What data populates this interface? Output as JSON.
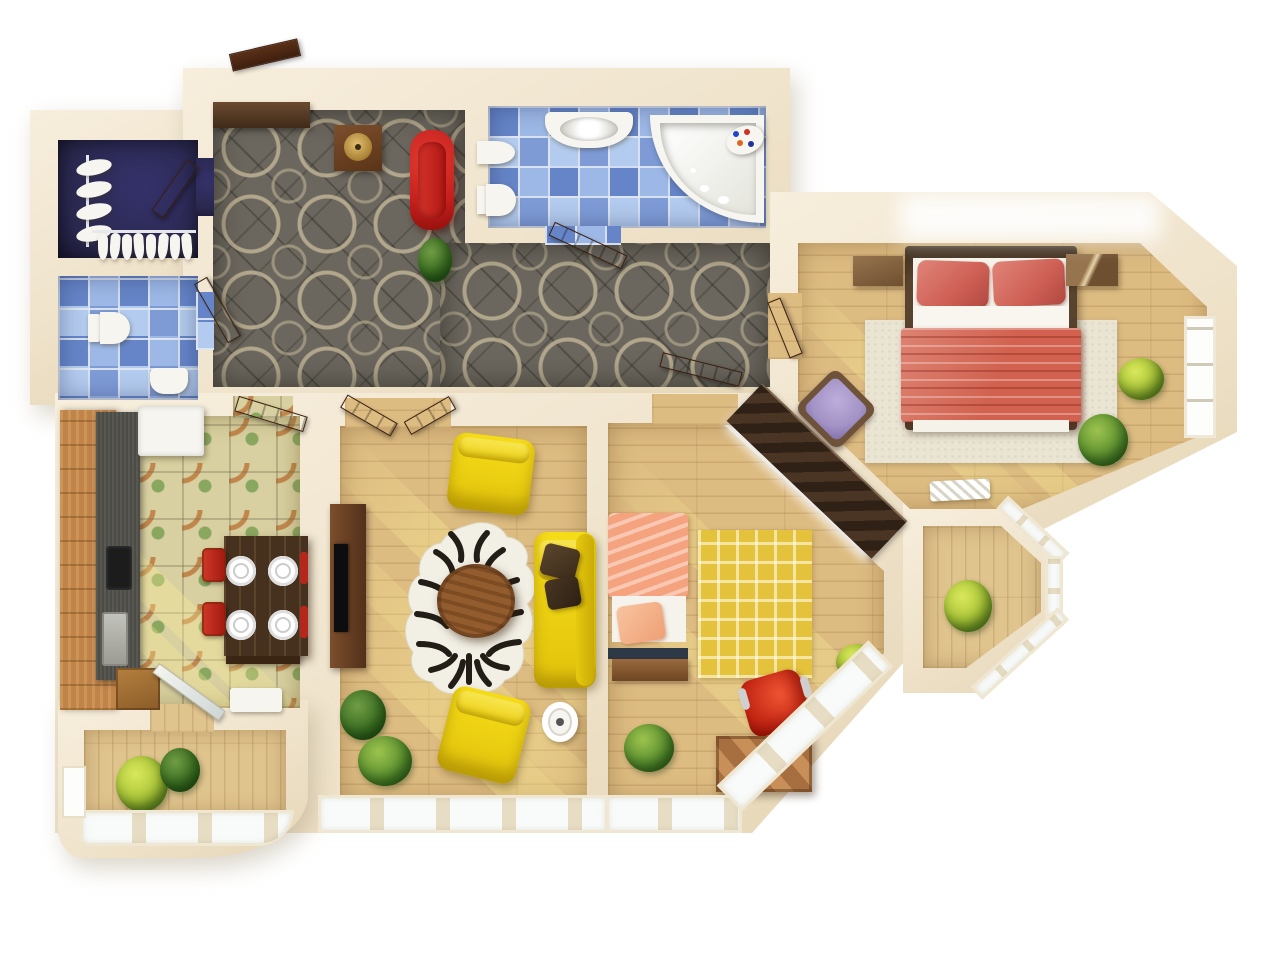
{
  "title": "3D apartment floor plan (top-down render)",
  "colors": {
    "wall": "#efe3cb",
    "wallLight": "#f7eedd",
    "woodFloor": "#ddbc82",
    "woodFloorLight": "#e0c48e",
    "carpet": "#6b675e",
    "tileBlue": "#7e9bd6",
    "tileGreen": "#d8d0a0",
    "navy": "#2b2950",
    "accentRed": "#c41f1c",
    "sofaYellow": "#f0d313",
    "bedCoral": "#d2614f",
    "pillowCoral": "#ce5f55",
    "kidsPeach": "#f5a37f",
    "rugYellow": "#e4c23c",
    "rugBeige": "#eae4d3",
    "doorWood": "#5f351f",
    "darkWood": "#46311f",
    "counterWood": "#c08449",
    "plantGreen": "#5e9330"
  },
  "rooms": [
    {
      "id": "entry-hall",
      "name": "Entry hall with patterned gray carpet"
    },
    {
      "id": "closet",
      "name": "Wardrobe closet with shoe racks"
    },
    {
      "id": "wc",
      "name": "WC with blue mosaic tile"
    },
    {
      "id": "bathroom",
      "name": "Bathroom with blue mosaic tile"
    },
    {
      "id": "bedroom",
      "name": "Master bedroom with double bed"
    },
    {
      "id": "kitchen",
      "name": "Kitchen with green tile and dining table"
    },
    {
      "id": "living-room",
      "name": "Living room with yellow sofa set"
    },
    {
      "id": "kids-room",
      "name": "Second bedroom / study"
    },
    {
      "id": "balcony-left",
      "name": "Curved balcony with plants"
    },
    {
      "id": "balcony-right",
      "name": "Small bay balcony"
    }
  ],
  "furniture": {
    "entry_hall": [
      "entrance door",
      "wall cabinet",
      "side table with brass bowl",
      "red bench",
      "plant"
    ],
    "closet": [
      "hanger rail",
      "shoe shelves",
      "door"
    ],
    "wc": [
      "toilet",
      "small sink"
    ],
    "bathroom": [
      "vanity sink",
      "bidet",
      "toilet",
      "corner bathtub",
      "soap tray"
    ],
    "bedroom": [
      "double bed with coral bedding",
      "two nightstands",
      "beige rug",
      "purple armchair",
      "two plants",
      "white floor grate",
      "window"
    ],
    "kitchen": [
      "wood counter",
      "gray countertop",
      "fridge",
      "cooktop",
      "sink",
      "dining table",
      "four red chairs",
      "white plates",
      "open glass door"
    ],
    "living_room": [
      "tv stand with tv",
      "two yellow armchairs",
      "yellow sofa with brown pillows",
      "zebra rug",
      "round wood table",
      "white side table",
      "two plants",
      "double doors"
    ],
    "kids_room": [
      "single bed with peach bedding",
      "yellow greek-key rug",
      "red office chair",
      "wood desk",
      "diagonal wardrobe",
      "two plants"
    ],
    "balcony_left": [
      "two plants",
      "curved window band"
    ],
    "balcony_right": [
      "plant",
      "bay windows"
    ]
  }
}
